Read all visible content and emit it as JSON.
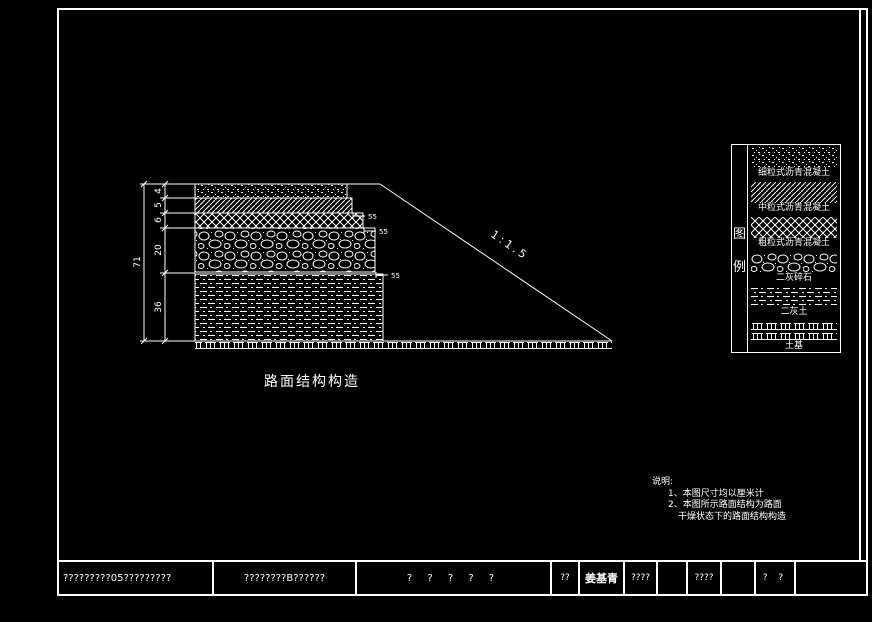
{
  "drawing": {
    "caption": "路面结构构造",
    "slope_label": "1:1.5",
    "dimensions": {
      "total": "71",
      "layer_thicknesses": [
        "4",
        "5",
        "6",
        "20",
        "36"
      ],
      "step_offsets": [
        "55",
        "55",
        "55"
      ]
    }
  },
  "legend": {
    "title_chars": [
      "图",
      "例"
    ],
    "items": [
      {
        "label": "细粒式沥青混凝土",
        "pattern": "speckle"
      },
      {
        "label": "中粒式沥青混凝土",
        "pattern": "diagonal-hatch"
      },
      {
        "label": "粗粒式沥青混凝土",
        "pattern": "diamond-hatch"
      },
      {
        "label": "二灰碎石",
        "pattern": "cobble"
      },
      {
        "label": "二灰土",
        "pattern": "dash-dot"
      },
      {
        "label": "土基",
        "pattern": "subgrade"
      }
    ]
  },
  "notes": {
    "heading": "说明:",
    "line1": "1、本图尺寸均以厘米计",
    "line2": "2、本图所示路面结构为路面",
    "line3": "干燥状态下的路面结构构造"
  },
  "titleblock": {
    "cell1": "?????????05?????????",
    "cell2": "????????B??????",
    "cell3": "? ? ? ? ?",
    "cell4": "??",
    "cell5": "姜基青",
    "cell6": "????",
    "cell7": "",
    "cell8": "????",
    "cell9": "",
    "cell10": "? ?",
    "cell11": ""
  },
  "colors": {
    "background": "#000000",
    "line": "#ffffff"
  }
}
